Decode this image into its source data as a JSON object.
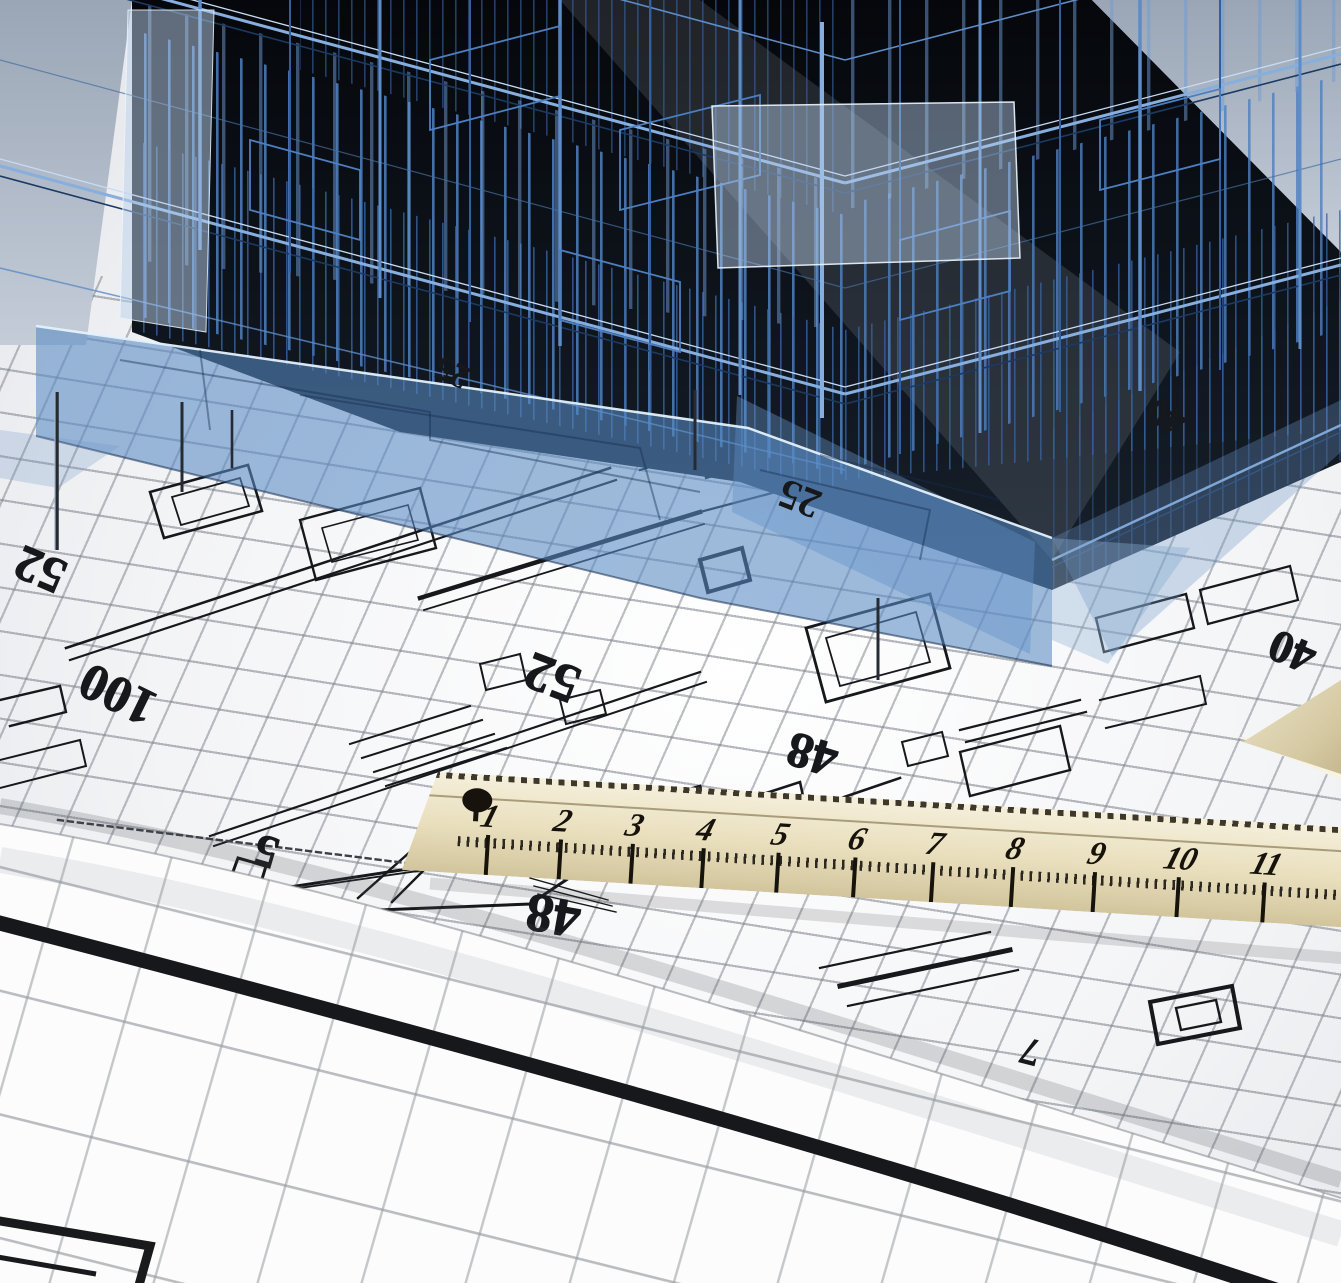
{
  "scene": {
    "title": "Architectural blueprint scene",
    "description": "Translucent blue 3D wireframe building model standing over architectural floor-plan blueprints, with a wooden ruler, a rolled grid sheet and the corner of a set square",
    "objects": [
      "wireframe-building",
      "blueprint-floor-plan",
      "wooden-ruler",
      "rolled-blueprint-sheet",
      "set-square-corner"
    ]
  },
  "colors": {
    "wireframe_light_blue": "#86aede",
    "wireframe_mid_blue": "#4d7fc0",
    "wireframe_dark_blue": "#2b4f86",
    "glass_blue": "#588ac2",
    "building_background": "#0a0f16",
    "sky_gray": "#b9c2cf",
    "paper_white": "#f6f7f8",
    "grid_gray": "#7a8089",
    "plan_ink": "#17181c",
    "ruler_wood_light": "#f5efdb",
    "ruler_wood_dark": "#d2c59d",
    "ruler_ink": "#17130c"
  },
  "ruler": {
    "numbers": [
      "1",
      "2",
      "3",
      "4",
      "5",
      "6",
      "7",
      "8",
      "9",
      "10",
      "11"
    ]
  },
  "labels": {
    "plan": [
      {
        "text": "52"
      },
      {
        "text": "100"
      },
      {
        "text": "52"
      },
      {
        "text": "48"
      },
      {
        "text": "40"
      },
      {
        "text": "5"
      },
      {
        "text": "48"
      }
    ],
    "under_glass": [
      {
        "text": "25"
      },
      {
        "text": "25"
      },
      {
        "text": "40"
      }
    ],
    "foreground": [
      {
        "text": "7"
      }
    ]
  }
}
